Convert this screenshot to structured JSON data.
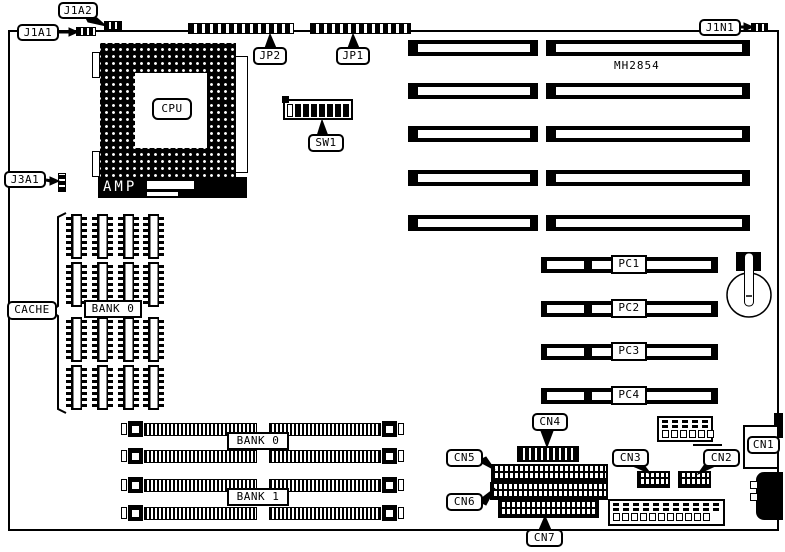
{
  "diagram": {
    "type": "motherboard-layout",
    "board_model_text": "MH2854",
    "labels": {
      "j1a1": "J1A1",
      "j1a2": "J1A2",
      "j1n1": "J1N1",
      "j3a1": "J3A1",
      "jp1": "JP1",
      "jp2": "JP2",
      "sw1": "SW1",
      "cpu": "CPU",
      "amp": "AMP",
      "cache": "CACHE",
      "cache_bank": "BANK 0",
      "simm_bank_0": "BANK 0",
      "simm_bank_1": "BANK 1",
      "cn1": "CN1",
      "cn2": "CN2",
      "cn3": "CN3",
      "cn4": "CN4",
      "cn5": "CN5",
      "cn6": "CN6",
      "cn7": "CN7"
    },
    "pci": {
      "labels": [
        "PC1",
        "PC2",
        "PC3",
        "PC4"
      ]
    },
    "counts": {
      "isa_slot_rows": 5,
      "simm_slots": 4,
      "cache_chip_rows": 4,
      "cache_chip_cols": 4,
      "dip_switch_positions": 8,
      "power_connector_small_pins": 6,
      "power_connector_large_pins": 11
    },
    "colors": {
      "ink": "#000000",
      "paper": "#ffffff"
    }
  }
}
